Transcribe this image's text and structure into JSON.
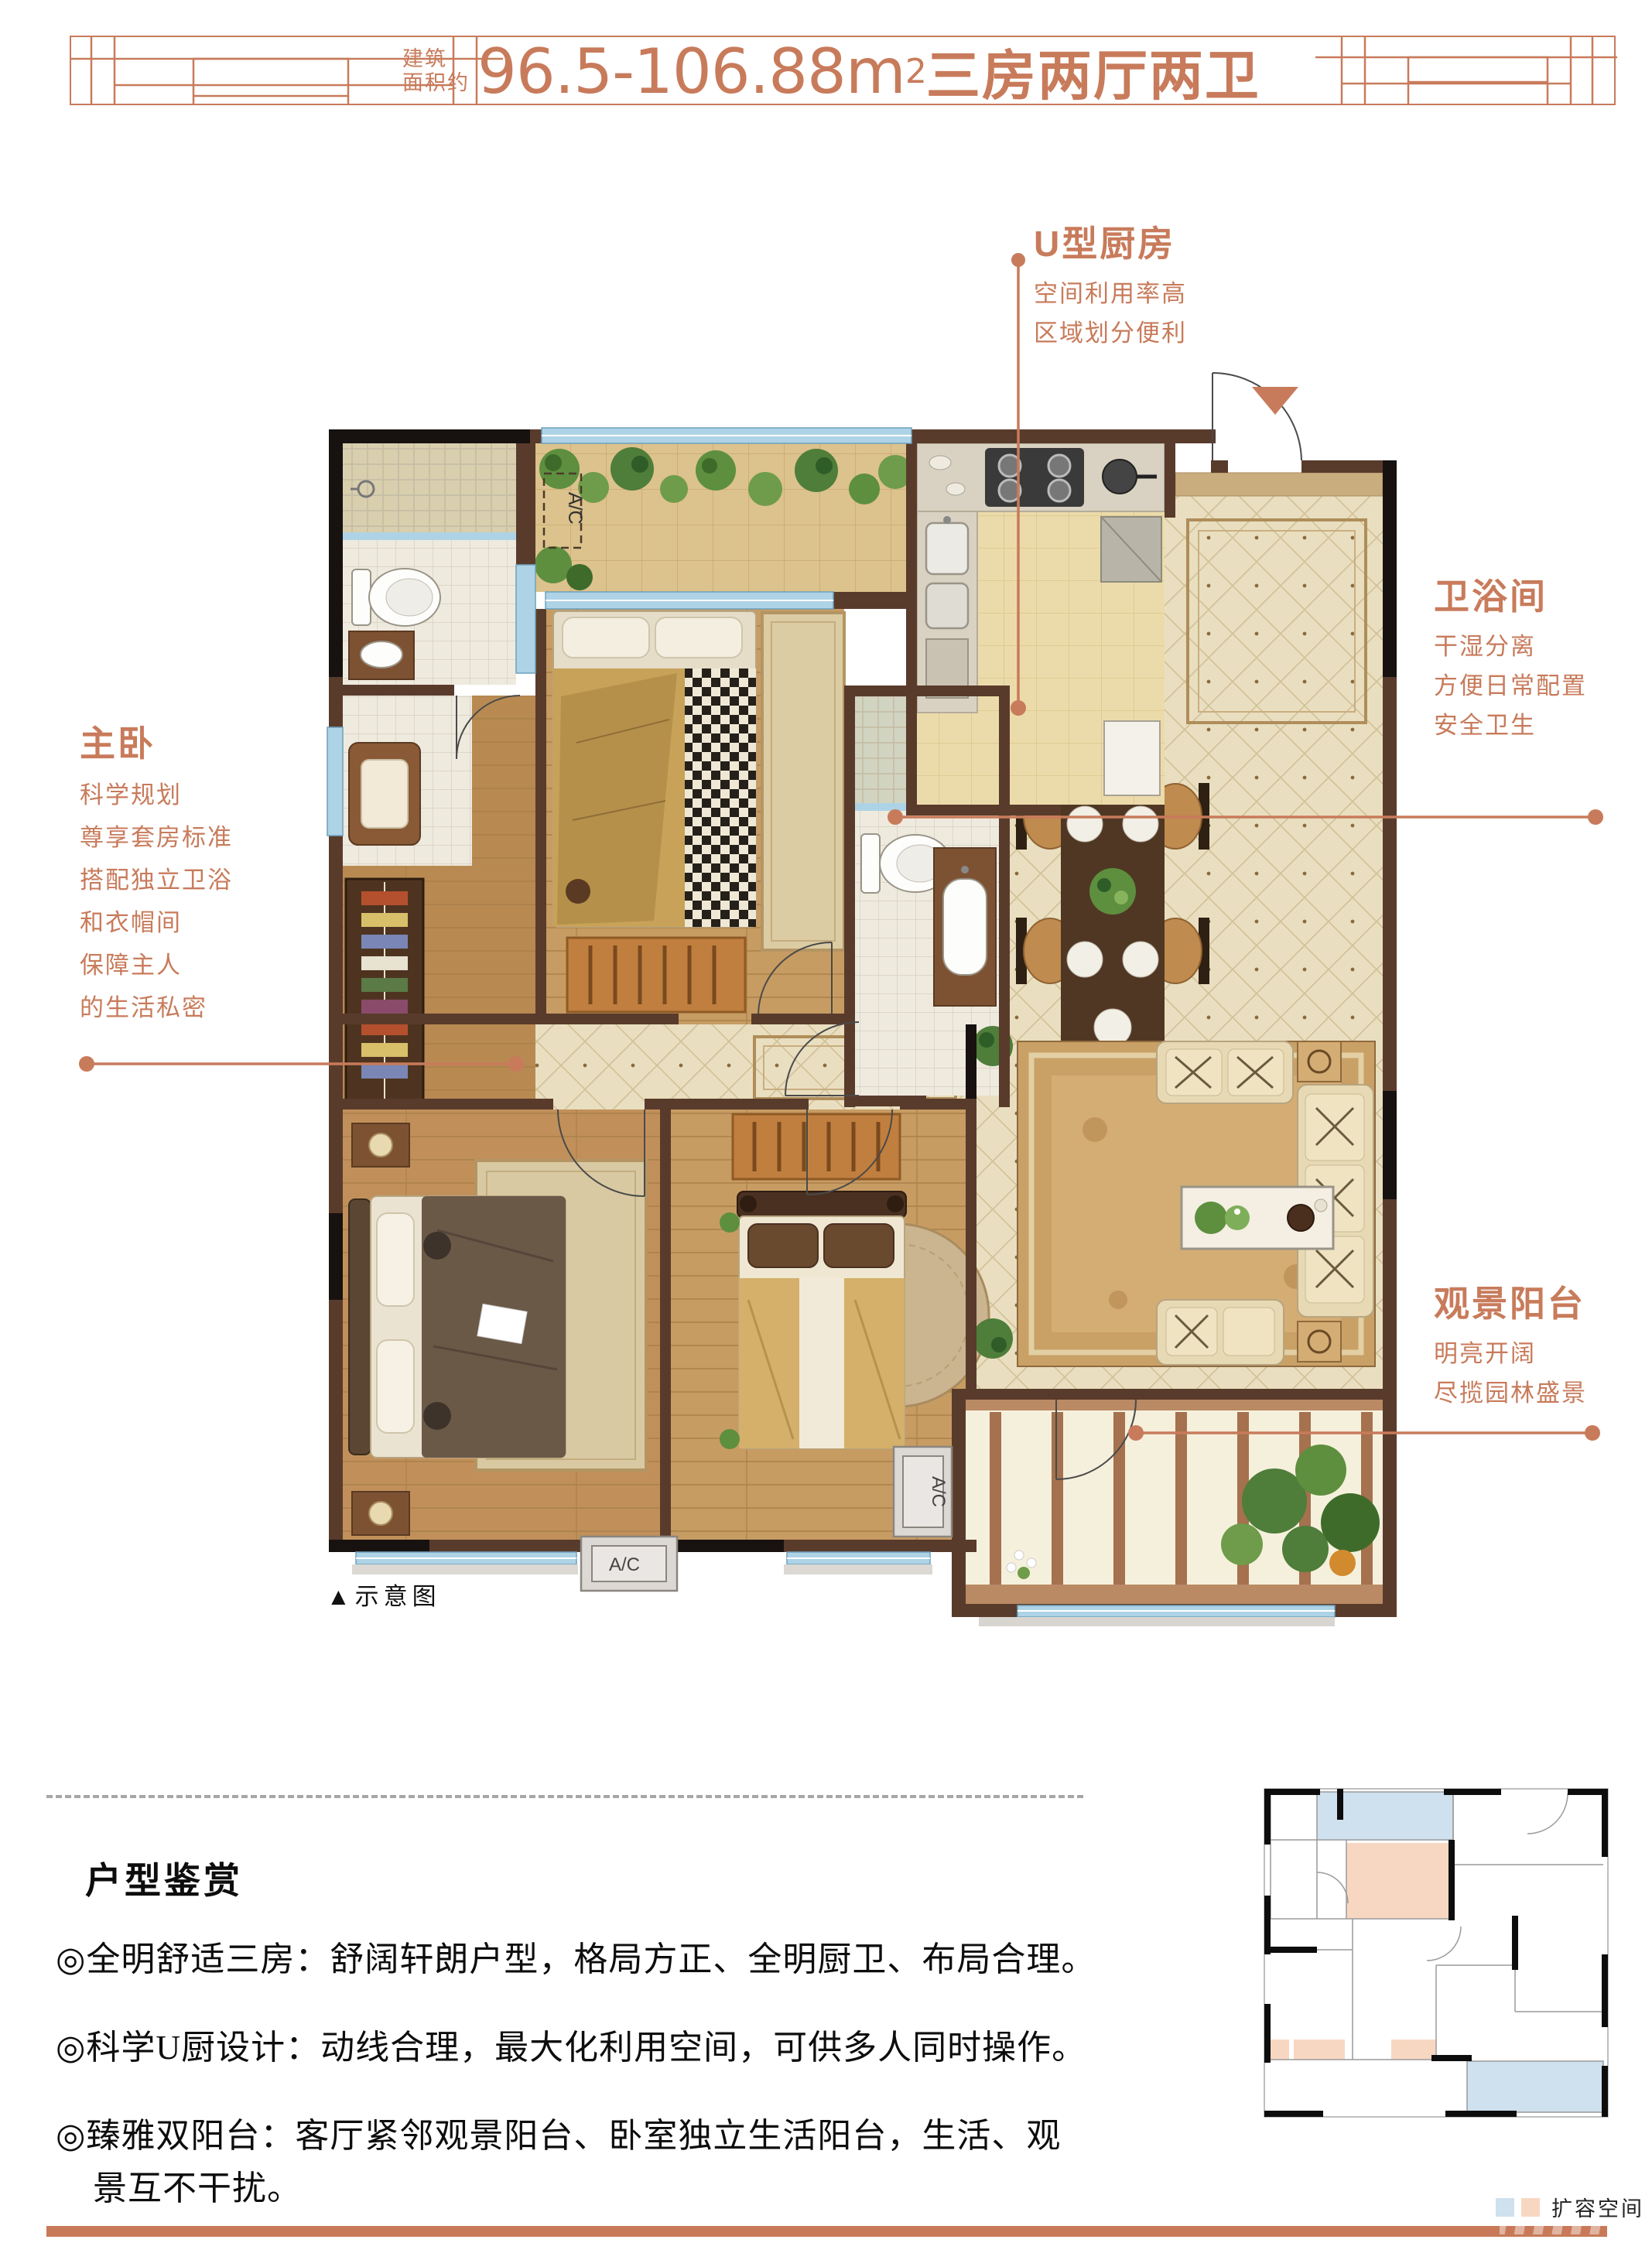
{
  "page": {
    "accent_color": "#c87b5b",
    "wall_color": "#593b2c",
    "bar_color": "#c87a58"
  },
  "header": {
    "area_label_line1": "建筑",
    "area_label_line2": "面积约",
    "area_value": "96.5-106.88m",
    "area_sup": "2",
    "layout_text": "三房两厅两卫"
  },
  "callouts": {
    "kitchen": {
      "title": "U型厨房",
      "lines": [
        "空间利用率高",
        "区域划分便利"
      ]
    },
    "bathroom": {
      "title": "卫浴间",
      "lines": [
        "干湿分离",
        "方便日常配置",
        "安全卫生"
      ]
    },
    "master": {
      "title": "主卧",
      "lines": [
        "科学规划",
        "尊享套房标准",
        "搭配独立卫浴",
        "和衣帽间",
        "保障主人",
        "的生活私密"
      ]
    },
    "balcony": {
      "title": "观景阳台",
      "lines": [
        "明亮开阔",
        "尽揽园林盛景"
      ]
    }
  },
  "plan": {
    "caption": "▲示意图",
    "ac_label": "A/C"
  },
  "review": {
    "title": "户型鉴赏",
    "bullets": [
      "◎全明舒适三房：舒阔轩朗户型，格局方正、全明厨卫、布局合理。",
      "◎科学U厨设计：动线合理，最大化利用空间，可供多人同时操作。",
      "◎臻雅双阳台：客厅紧邻观景阳台、卧室独立生活阳台，生活、观",
      "景互不干扰。"
    ]
  },
  "mini_plan": {
    "legend_label": "扩容空间",
    "legend_blue": "#cfe0ee",
    "legend_pink": "#f8d7c2"
  }
}
